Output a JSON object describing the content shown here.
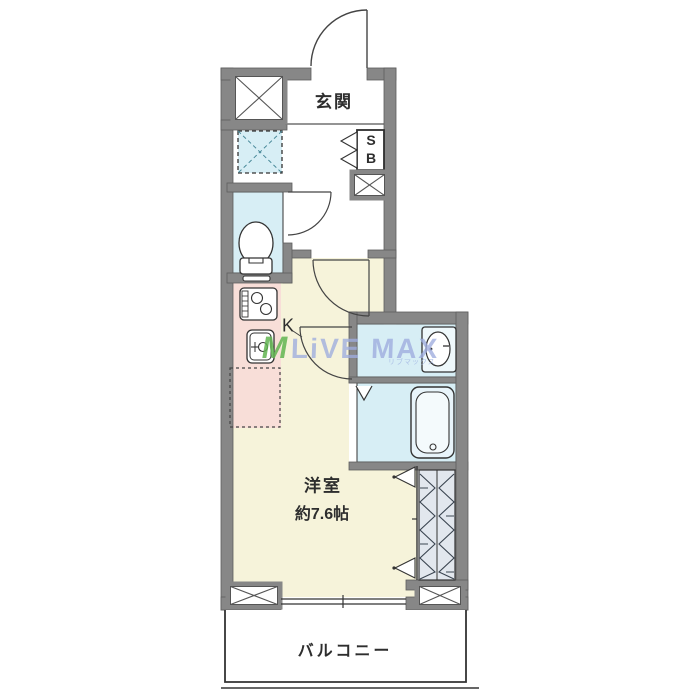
{
  "plan": {
    "labels": {
      "entrance": "玄関",
      "shoe_box_top": "S",
      "shoe_box_bottom": "B",
      "kitchen": "K",
      "main_room": "洋室",
      "main_room_size": "約7.6帖",
      "balcony": "バルコニー"
    },
    "colors": {
      "wall": "#878787",
      "wet_area_floor": "#d7eef5",
      "kitchen_floor": "#f8ded8",
      "main_room_floor": "#f6f3da",
      "closet_fill": "#e2e7ee",
      "line": "#333333"
    },
    "fixtures": [
      "entrance-door",
      "shoe-box",
      "washing-machine-space",
      "toilet",
      "kitchen-stove",
      "kitchen-sink",
      "refrigerator-space",
      "wash-basin",
      "bathtub",
      "bath-folding-door",
      "closet",
      "interior-door",
      "window",
      "pillar"
    ]
  },
  "watermark": {
    "logo": "M",
    "text": "LiVE MAX",
    "subtext": "リブマックス",
    "text_color": "#9eacde",
    "logo_color": "#60b450"
  }
}
